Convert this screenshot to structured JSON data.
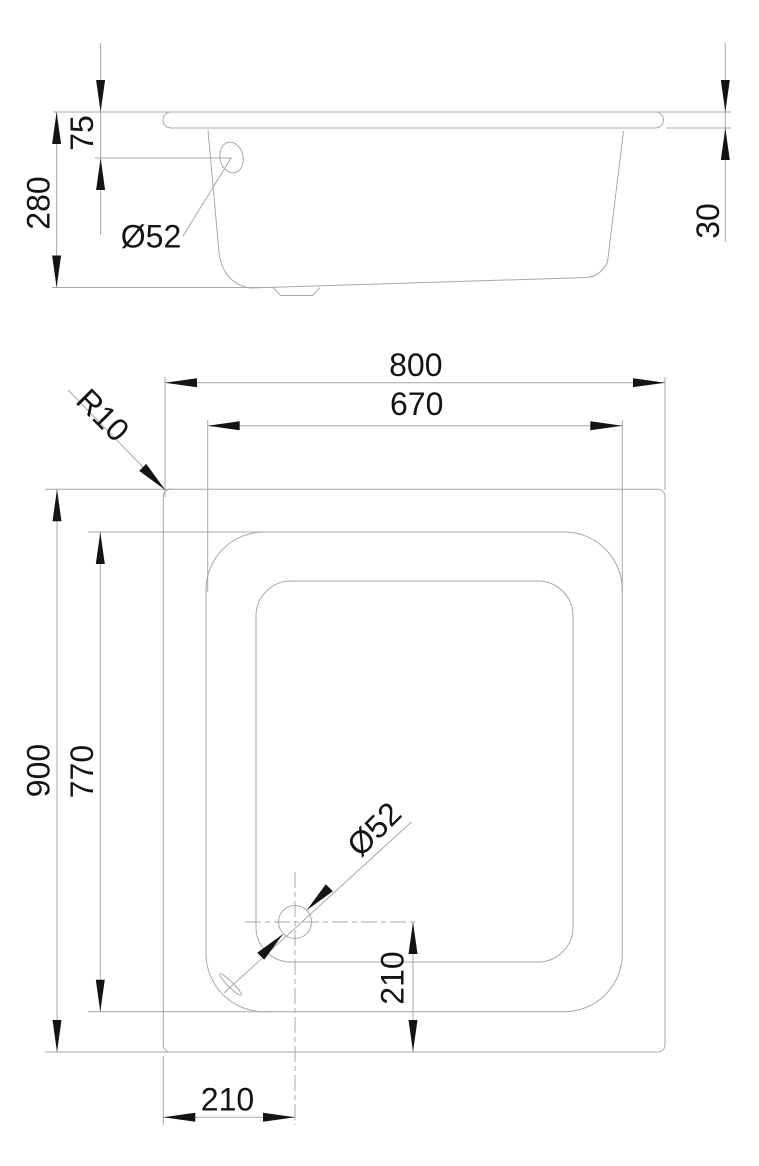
{
  "side_view": {
    "label_rim_to_drain_center": "75",
    "label_total_depth": "280",
    "label_drain_diameter": "Ø52",
    "label_rim_thickness": "30"
  },
  "plan_view": {
    "label_outer_width": "800",
    "label_inner_width": "670",
    "label_corner_radius": "R10",
    "label_outer_length": "900",
    "label_inner_length": "770",
    "label_drain_diameter": "Ø52",
    "label_drain_offset_from_bottom": "210",
    "label_drain_offset_from_left": "210"
  },
  "colors": {
    "background": "#ffffff",
    "line": "#a9a9a9",
    "dimension_text": "#141414",
    "arrow": "#141414"
  }
}
